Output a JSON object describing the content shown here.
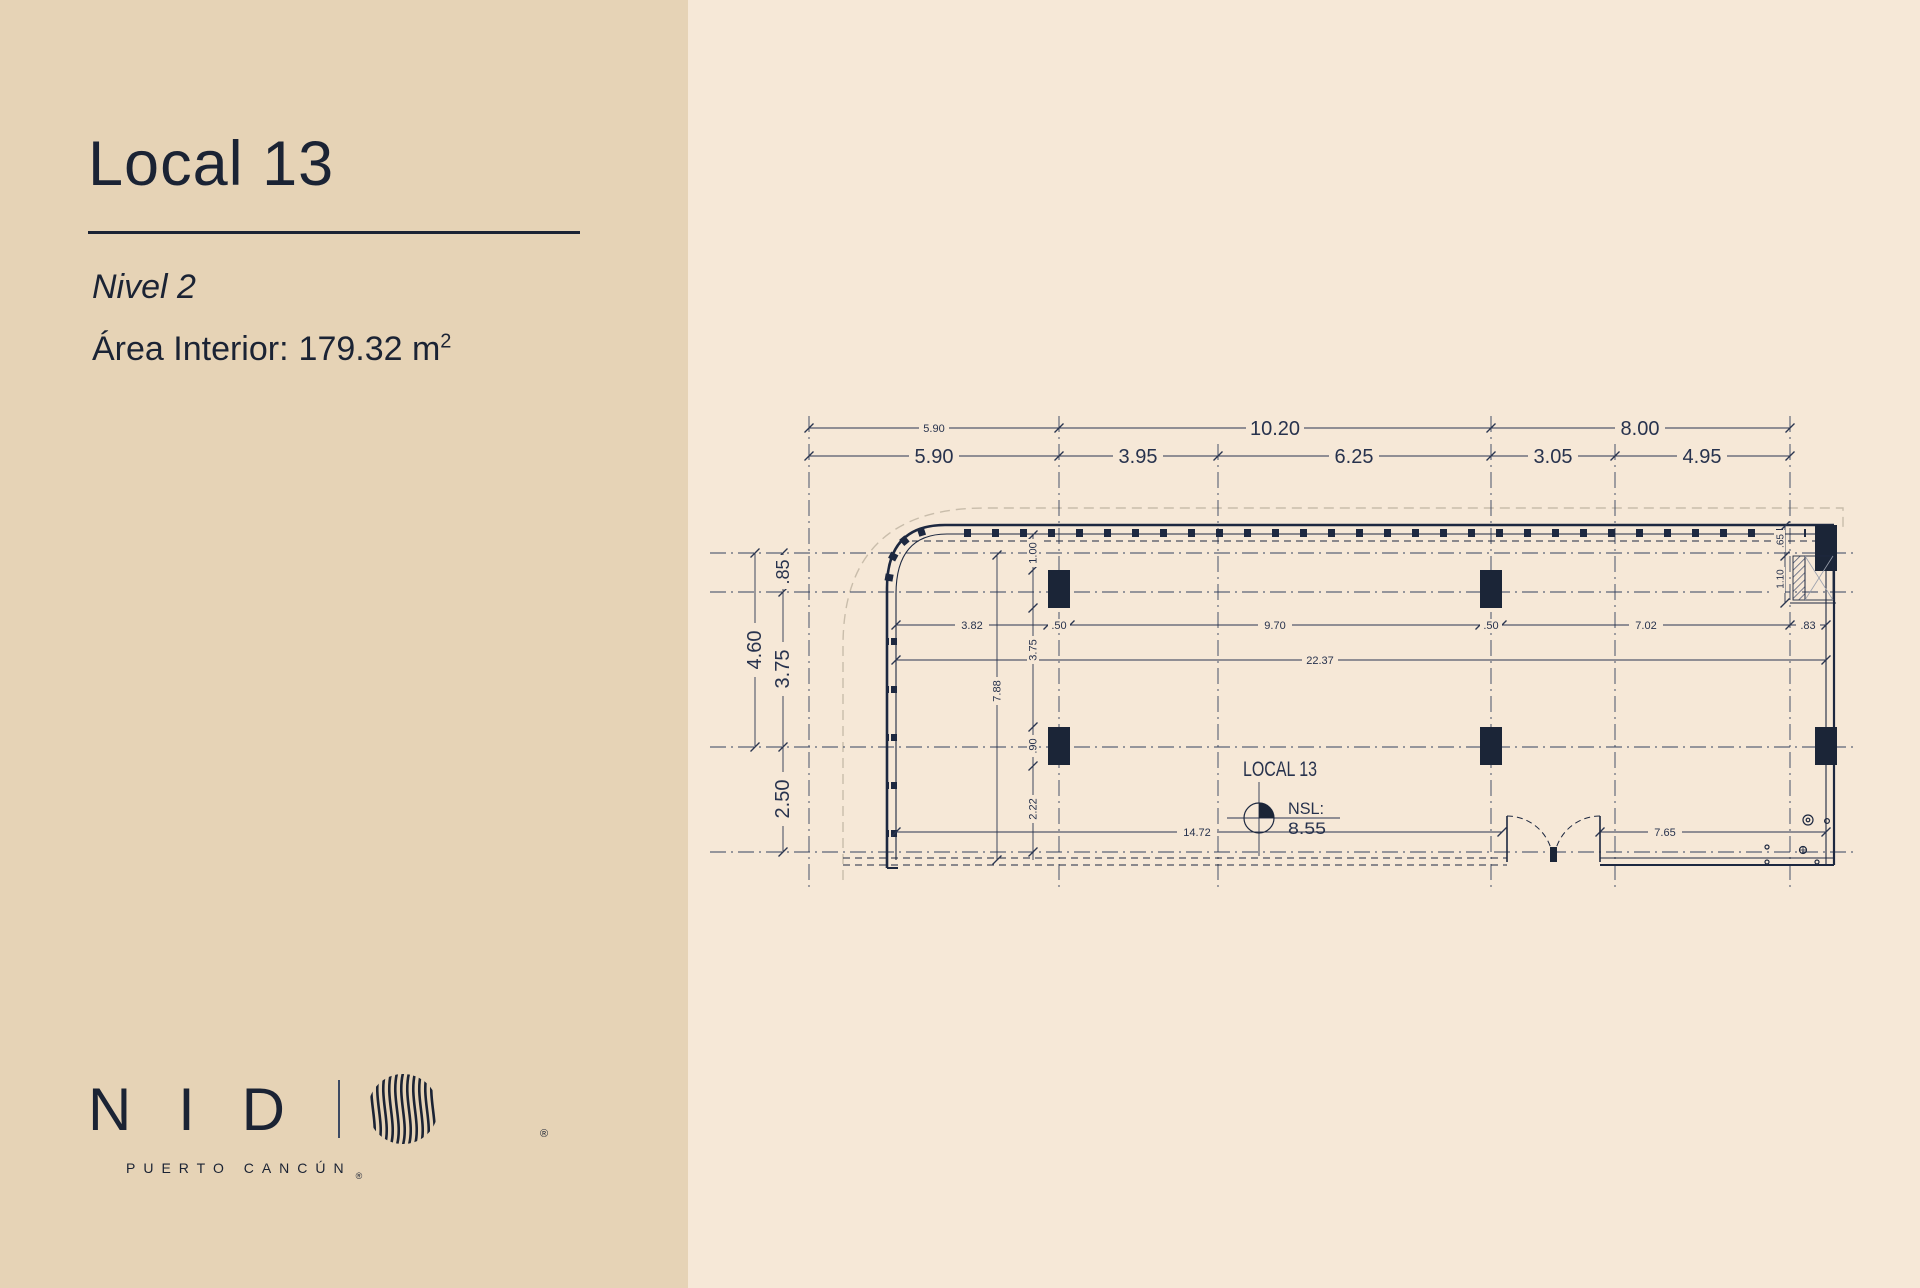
{
  "panel": {
    "title": "Local 13",
    "level": "Nivel 2",
    "area_label": "Área Interior:",
    "area_value": "179.32 m",
    "area_sup": "2"
  },
  "logo": {
    "letters": "NID",
    "subtitle": "PUERTO CANCÚN",
    "registered": "®"
  },
  "plan": {
    "name": "LOCAL 13",
    "nsl_label": "NSL:",
    "nsl_value": "8.55",
    "dims_top_row1": [
      "5.90",
      "10.20",
      "8.00"
    ],
    "dims_top_row2": [
      "5.90",
      "3.95",
      "6.25",
      "3.05",
      "4.95"
    ],
    "dims_left_outer": [
      "4.60"
    ],
    "dims_left_inner": [
      ".85",
      "3.75",
      "2.50"
    ],
    "dims_interior_row": [
      "3.82",
      ".50",
      "9.70",
      ".50",
      "7.02",
      ".83"
    ],
    "dims_interior_total": "22.37",
    "dims_interior_vert": [
      "1.00",
      "3.75",
      ".90",
      "2.22"
    ],
    "dims_left_span": "7.88",
    "dims_bottom": [
      "14.72",
      "7.65"
    ],
    "dims_right_vert": [
      ".65",
      "1.10"
    ]
  },
  "colors": {
    "panel_bg": "#e6d3b6",
    "canvas_bg": "#f6e8d7",
    "ink": "#1d2840",
    "grid": "#34425f",
    "lot_line": "#c9bdab"
  }
}
